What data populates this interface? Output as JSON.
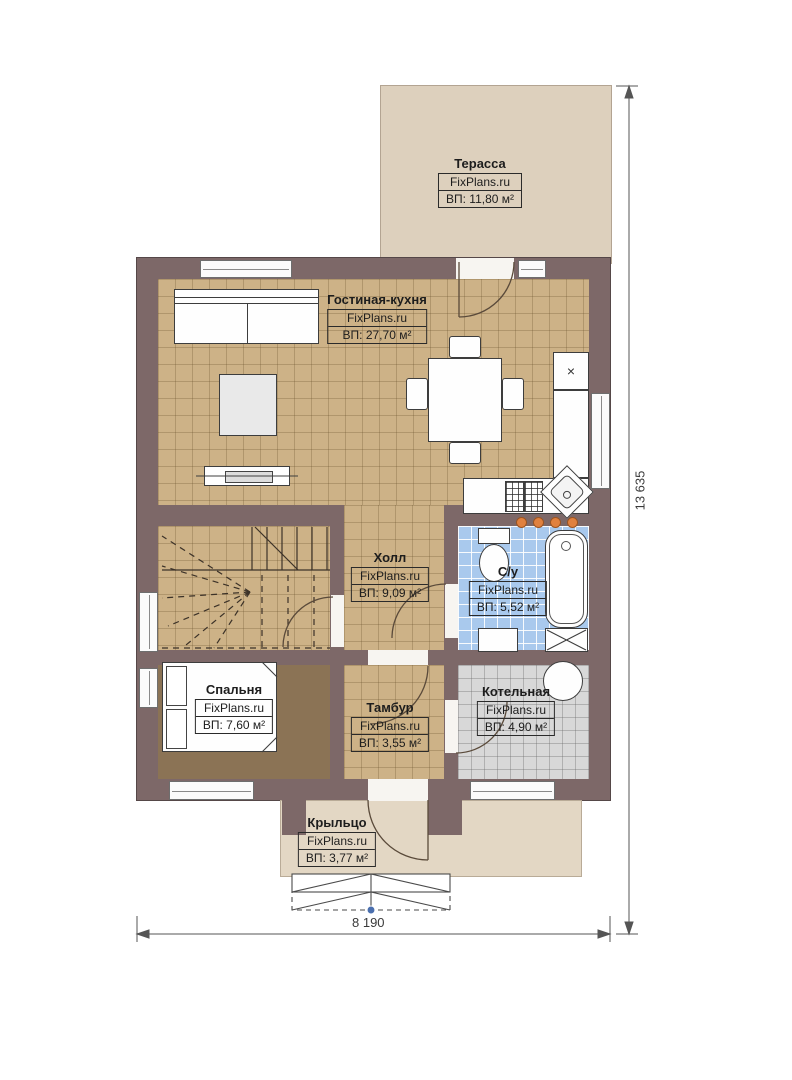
{
  "brand": "FixPlans.ru",
  "rooms": {
    "terrace": {
      "name": "Терасса",
      "area": "ВП: 11,80 м²"
    },
    "living": {
      "name": "Гостиная-кухня",
      "area": "ВП: 27,70 м²"
    },
    "hall": {
      "name": "Холл",
      "area": "ВП: 9,09 м²"
    },
    "bathroom": {
      "name": "С/у",
      "area": "ВП: 5,52 м²"
    },
    "bedroom": {
      "name": "Спальня",
      "area": "ВП: 7,60 м²"
    },
    "vestibule": {
      "name": "Тамбур",
      "area": "ВП: 3,55 м²"
    },
    "boiler": {
      "name": "Котельная",
      "area": "ВП: 4,90 м²"
    },
    "porch": {
      "name": "Крыльцо",
      "area": "ВП: 3,77 м²"
    }
  },
  "dimensions": {
    "width": "8 190",
    "height": "13 635"
  },
  "symbols": {
    "fridge": "×"
  },
  "colors": {
    "wall": "#7d6868",
    "floor_tile_tan": "#cdb287",
    "floor_bathroom_blue": "#a9c9ed",
    "floor_boiler_gray": "#d8d8d8",
    "floor_bedroom_brown": "#8b7355",
    "terrace_fill": "#ddd0bd",
    "porch_fill": "#e3d7c4",
    "radiator_dot_orange": "#e0813f",
    "dimension_marker_blue": "#4a6fae"
  }
}
